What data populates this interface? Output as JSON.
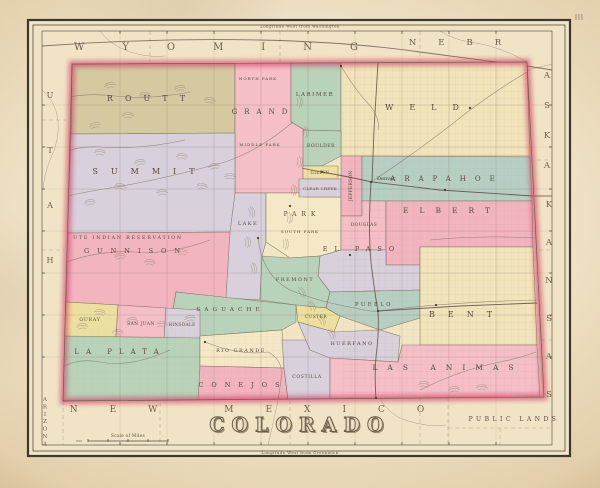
{
  "page": {
    "map_title": "COLORADO",
    "top_caption": "Longitude West from Washington",
    "bottom_caption": "Longitude West from Greenwich",
    "scale_caption": "Scale of Miles"
  },
  "colors": {
    "paper": "#f1e4c6",
    "state_base": "#f2e5c4",
    "frame": "#3e372e",
    "state_border_red": "#cf3560",
    "county_line": "#6e6150",
    "label_ink": "#574a3d",
    "neighbor_ink": "#6d5d4b",
    "water_ink": "#7d7060",
    "rail_ink": "#4f4438",
    "pink": "#f2b4bf",
    "pink2": "#f5bfc7",
    "green": "#b9d2ba",
    "teal": "#b7cfc2",
    "cream": "#f1e3ba",
    "cream2": "#f4e8c6",
    "lavender": "#d8d0da",
    "yellow": "#ecdf9f",
    "olive": "#d5c9a2"
  },
  "frame": {
    "outer": [
      28,
      20,
      542,
      436
    ],
    "outer2": [
      33,
      25,
      532,
      426
    ],
    "inner": [
      42,
      31,
      510,
      414
    ],
    "top_caption_pos": [
      300,
      27.5
    ],
    "bottom_caption_pos": [
      300,
      454
    ]
  },
  "state_outline": "M72,64 L527,62 L544,397 L63,401 Z",
  "graticule": {
    "xs": [
      120,
      167,
      214,
      261,
      308,
      355,
      402,
      449,
      496
    ],
    "ys": [
      105,
      147,
      189,
      231,
      273,
      315,
      357
    ]
  },
  "counties": [
    {
      "name": "ROUTT",
      "color": "olive",
      "points": "72,64 235,63 235,133 71,134",
      "label": {
        "x": 152,
        "y": 101,
        "size": 8,
        "spacing": 12
      }
    },
    {
      "name": "GRAND",
      "color": "pink2",
      "points": "235,63 291,62 291,122 305,130 303,179 299,193 235,193",
      "label": {
        "x": 263,
        "y": 114,
        "size": 7,
        "spacing": 7
      }
    },
    {
      "name": "LARIMER",
      "color": "green",
      "points": "291,62 341,61 341,131 305,130 291,122",
      "label": {
        "x": 315,
        "y": 96,
        "size": 5.5,
        "spacing": 1.5
      }
    },
    {
      "name": "WELD",
      "color": "cream",
      "points": "341,61 527,62 530,156 341,156",
      "label": {
        "x": 430,
        "y": 110,
        "size": 8,
        "spacing": 16
      }
    },
    {
      "name": "SUMMIT",
      "color": "lavender",
      "points": "71,134 235,133 235,232 67,233",
      "label": {
        "x": 150,
        "y": 174,
        "size": 8,
        "spacing": 13
      }
    },
    {
      "name": "GUNNISON",
      "color": "pink",
      "points": "67,233 235,232 228,298 176,292 172,316 160,310 118,305 66,302",
      "label": {
        "x": 136,
        "y": 253,
        "size": 6.5,
        "spacing": 8
      }
    },
    {
      "name": "LAKE",
      "color": "lavender",
      "points": "235,193 266,193 266,242 262,256 260,300 226,298 230,232",
      "label": {
        "x": 248,
        "y": 225,
        "size": 5,
        "spacing": 1.5
      }
    },
    {
      "name": "PARK",
      "color": "cream2",
      "points": "266,193 305,193 305,197 341,197 341,250 320,256 290,258 266,242",
      "label": {
        "x": 302,
        "y": 216,
        "size": 6,
        "spacing": 5
      }
    },
    {
      "name": "BOULDER",
      "color": "green",
      "points": "303,130 341,131 341,156 322,166 303,166",
      "label": {
        "x": 321,
        "y": 147,
        "size": 4.6,
        "spacing": 0.5
      }
    },
    {
      "name": "GILPIN",
      "color": "yellow",
      "points": "303,166 338,166 338,179 303,179",
      "label": {
        "x": 320,
        "y": 174,
        "size": 4.2,
        "spacing": 0.5
      }
    },
    {
      "name": "CLEAR CREEK",
      "color": "lavender",
      "points": "299,179 341,179 341,197 299,197",
      "label": {
        "x": 320,
        "y": 190,
        "size": 4,
        "spacing": 0.3
      }
    },
    {
      "name": "JEFFERSON",
      "color": "pink",
      "points": "341,156 362,156 362,216 341,216",
      "label": {
        "x": 352,
        "y": 186,
        "size": 4.4,
        "spacing": 0.3,
        "rot": -90
      }
    },
    {
      "name": "ARAPAHOE",
      "color": "teal",
      "points": "362,156 530,157 532,201 362,201",
      "label": {
        "x": 447,
        "y": 181,
        "size": 7,
        "spacing": 9
      }
    },
    {
      "name": "DOUGLAS",
      "color": "pink2",
      "points": "341,216 362,216 362,201 386,201 386,250 341,250",
      "label": {
        "x": 364,
        "y": 226,
        "size": 4.4,
        "spacing": 0.4
      }
    },
    {
      "name": "ELBERT",
      "color": "pink",
      "points": "386,201 532,201 533,247 420,247 420,265 386,265",
      "label": {
        "x": 452,
        "y": 213,
        "size": 7.5,
        "spacing": 11
      }
    },
    {
      "name": "EL PASO",
      "color": "lavender",
      "points": "320,256 341,250 386,250 386,265 420,265 420,290 330,292 318,276",
      "label": {
        "x": 362,
        "y": 251,
        "size": 6.5,
        "spacing": 7
      }
    },
    {
      "name": "FREMONT",
      "color": "green",
      "points": "262,256 290,258 320,256 318,276 330,292 326,308 296,305 260,300",
      "label": {
        "x": 295,
        "y": 281,
        "size": 5,
        "spacing": 1.5
      }
    },
    {
      "name": "SAGUACHE",
      "color": "green",
      "points": "176,292 250,300 296,305 296,322 282,330 200,336 172,316",
      "label": {
        "x": 230,
        "y": 311,
        "size": 5.8,
        "spacing": 4
      }
    },
    {
      "name": "CUSTER",
      "color": "yellow",
      "points": "296,305 326,308 340,316 334,332 298,322",
      "label": {
        "x": 316,
        "y": 318,
        "size": 4.4,
        "spacing": 0.5
      }
    },
    {
      "name": "PUEBLO",
      "color": "teal",
      "points": "330,292 420,290 420,318 380,330 340,316 326,308",
      "label": {
        "x": 374,
        "y": 306,
        "size": 5.2,
        "spacing": 2.5
      }
    },
    {
      "name": "BENT",
      "color": "cream",
      "points": "420,247 533,247 537,345 420,345",
      "label": {
        "x": 467,
        "y": 317,
        "size": 8,
        "spacing": 13
      }
    },
    {
      "name": "OURAY",
      "color": "yellow",
      "points": "66,302 118,305 116,338 64,336",
      "label": {
        "x": 90,
        "y": 321,
        "size": 4.6,
        "spacing": 0.8
      }
    },
    {
      "name": "SAN JUAN",
      "color": "pink2",
      "points": "118,305 166,308 164,340 116,338",
      "label": {
        "x": 141,
        "y": 325,
        "size": 4.4,
        "spacing": 0.5
      }
    },
    {
      "name": "HINSDALE",
      "color": "lavender",
      "points": "166,308 200,310 200,338 164,340",
      "label": {
        "x": 182,
        "y": 326,
        "size": 4.2,
        "spacing": 0.4
      }
    },
    {
      "name": "LA PLATA",
      "color": "green",
      "points": "64,336 200,338 200,401 63,401",
      "label": {
        "x": 120,
        "y": 354,
        "size": 7,
        "spacing": 7
      }
    },
    {
      "name": "RIO GRANDE",
      "color": "cream2",
      "points": "200,336 282,330 284,368 200,366",
      "label": {
        "x": 241,
        "y": 352,
        "size": 5,
        "spacing": 1.5
      }
    },
    {
      "name": "CONEJOS",
      "color": "pink",
      "points": "200,366 284,368 288,400 198,401",
      "label": {
        "x": 243,
        "y": 387,
        "size": 6.5,
        "spacing": 8
      }
    },
    {
      "name": "COSTILLA",
      "color": "lavender",
      "points": "282,340 330,340 330,400 288,400 284,368",
      "label": {
        "x": 307,
        "y": 378,
        "size": 4.6,
        "spacing": 0.6
      }
    },
    {
      "name": "HUERFANO",
      "color": "lavender",
      "points": "334,332 380,330 400,336 398,362 330,358 310,350 298,322",
      "label": {
        "x": 352,
        "y": 345,
        "size": 5,
        "spacing": 1.5
      }
    },
    {
      "name": "LAS ANIMAS",
      "color": "pink2",
      "points": "330,358 398,362 402,345 420,345 537,345 540,397 330,400",
      "label": {
        "x": 448,
        "y": 370,
        "size": 7.5,
        "spacing": 10
      }
    }
  ],
  "misc_labels": [
    {
      "id": "ute-reservation-label",
      "text": "UTE INDIAN RESERVATION",
      "x": 128,
      "y": 239,
      "size": 4.8,
      "spacing": 1.8
    },
    {
      "id": "north-park-label",
      "text": "NORTH PARK",
      "x": 258,
      "y": 80,
      "size": 4,
      "spacing": 1
    },
    {
      "id": "middle-park-label",
      "text": "MIDDLE PARK",
      "x": 260,
      "y": 146,
      "size": 4,
      "spacing": 1
    },
    {
      "id": "south-park-label",
      "text": "SOUTH PARK",
      "x": 300,
      "y": 233,
      "size": 4,
      "spacing": 1
    },
    {
      "id": "public-lands-label",
      "text": "PUBLIC LANDS",
      "x": 514,
      "y": 421,
      "size": 6,
      "spacing": 3.5
    }
  ],
  "neighbors": [
    {
      "id": "wyoming-label",
      "text": "WYOMING",
      "x": 235,
      "y": 50,
      "size": 10,
      "spacing": 38
    },
    {
      "id": "nebraska-label-h",
      "text": "NEBR",
      "x": 466,
      "y": 45,
      "size": 8.5,
      "spacing": 22
    },
    {
      "id": "nebraska-label-v",
      "text": "ASKA",
      "x": 547,
      "y": 78,
      "size": 8.5,
      "vertical": true,
      "vspacing": 30
    },
    {
      "id": "kansas-label",
      "text": "KANSAS",
      "x": 549,
      "y": 207,
      "size": 8.5,
      "vertical": true,
      "vspacing": 38
    },
    {
      "id": "new-mexico-label",
      "text": "NEW MEXICO",
      "x": 263,
      "y": 412,
      "size": 9,
      "spacing": 32
    },
    {
      "id": "utah-label",
      "text": "UTAH",
      "x": 50,
      "y": 98,
      "size": 8,
      "vertical": true,
      "vspacing": 55
    },
    {
      "id": "arizona-label",
      "text": "ARIZONA",
      "x": 45,
      "y": 401,
      "size": 5.5,
      "vertical": true,
      "vspacing": 7.4
    }
  ],
  "towns": [
    {
      "name": "Denver",
      "x": 371,
      "y": 182,
      "labeled": true
    },
    {
      "x": 378,
      "y": 311
    },
    {
      "x": 322,
      "y": 172
    },
    {
      "x": 341,
      "y": 66
    },
    {
      "x": 350,
      "y": 255
    },
    {
      "x": 290,
      "y": 206
    },
    {
      "x": 258,
      "y": 238
    },
    {
      "x": 205,
      "y": 342
    },
    {
      "x": 445,
      "y": 190
    },
    {
      "x": 470,
      "y": 108
    },
    {
      "x": 436,
      "y": 305
    },
    {
      "x": 376,
      "y": 398
    }
  ],
  "rivers": [
    "M371,182 Q420,150 470,110 Q500,88 527,72",
    "M341,66 Q355,90 372,108 Q380,120 378,130",
    "M258,238 Q262,275 290,290 Q320,302 355,308 Q370,312 378,311 Q450,302 537,300",
    "M293,122 Q260,150 225,162 Q160,180 110,188 Q85,192 67,196",
    "M190,92 Q150,100 115,96 Q90,93 70,97",
    "M185,140 Q140,150 100,147 Q82,146 68,151",
    "M210,240 Q170,255 135,252 Q100,250 67,262",
    "M205,342 Q240,356 268,352 Q280,358 282,372 Q280,388 278,400",
    "M170,350 Q130,368 100,362 Q80,358 64,366",
    "M420,390 Q460,370 500,362 Q520,358 536,352",
    "M430,240 Q480,235 535,238"
  ],
  "railroads": [
    "M372,182 L374,130 L378,62",
    "M372,182 L440,190 L533,196",
    "M371,182 Q368,230 371,262 Q375,295 378,311",
    "M378,311 L460,306 L537,303",
    "M378,311 Q379,330 377,348 Q374,370 376,399",
    "M372,182 Q345,176 322,172 Q310,170 302,168"
  ],
  "margin_paths": [
    {
      "kind": "boundary",
      "d": "M150,31 V62"
    },
    {
      "kind": "boundary",
      "d": "M280,31 V62"
    },
    {
      "kind": "boundary",
      "d": "M420,31 V60"
    },
    {
      "kind": "boundary",
      "d": "M530,160 H552"
    },
    {
      "kind": "boundary",
      "d": "M532,250 H552"
    },
    {
      "kind": "boundary",
      "d": "M534,340 H552"
    },
    {
      "kind": "boundary",
      "d": "M290,400 V445"
    },
    {
      "kind": "boundary",
      "d": "M420,398 V445"
    },
    {
      "kind": "boundary",
      "d": "M160,403 V445"
    },
    {
      "kind": "boundary",
      "d": "M63,401 V445"
    },
    {
      "kind": "boundary",
      "d": "M42,120 H66"
    },
    {
      "kind": "boundary",
      "d": "M42,250 H64"
    },
    {
      "kind": "boundary",
      "d": "M448,398 V445"
    },
    {
      "kind": "boundary",
      "d": "M448,428 H552"
    },
    {
      "kind": "boundary",
      "d": "M500,428 V445"
    },
    {
      "kind": "river",
      "d": "M527,70 Q545,66 552,64"
    },
    {
      "kind": "river",
      "d": "M42,90 Q55,100 58,120 Q60,140 50,160 Q44,175 43,190"
    },
    {
      "kind": "river",
      "d": "M100,31 Q110,45 130,52 Q150,58 165,56"
    },
    {
      "kind": "river",
      "d": "M440,31 Q455,40 470,42 Q500,46 527,62"
    },
    {
      "kind": "river",
      "d": "M278,400 Q274,420 268,445"
    },
    {
      "kind": "river",
      "d": "M380,399 Q390,415 405,420 Q430,428 446,425"
    },
    {
      "kind": "rail",
      "d": "M42,46 Q150,38 260,40 Q350,42 420,52 Q480,60 527,66 Q540,68 552,70"
    },
    {
      "kind": "rail",
      "d": "M533,196 H552"
    }
  ],
  "terrain": [
    [
      110,
      85,
      -10
    ],
    [
      145,
      95,
      5
    ],
    [
      180,
      88,
      -5
    ],
    [
      210,
      100,
      8
    ],
    [
      128,
      115,
      0
    ],
    [
      95,
      125,
      -12
    ],
    [
      100,
      152,
      5
    ],
    [
      140,
      162,
      -6
    ],
    [
      182,
      156,
      4
    ],
    [
      214,
      166,
      -8
    ],
    [
      120,
      186,
      6
    ],
    [
      162,
      192,
      -4
    ],
    [
      202,
      186,
      5
    ],
    [
      90,
      202,
      -6
    ],
    [
      230,
      176,
      0
    ],
    [
      300,
      102,
      90
    ],
    [
      306,
      132,
      85
    ],
    [
      300,
      162,
      95
    ],
    [
      294,
      190,
      88
    ],
    [
      290,
      218,
      92
    ],
    [
      286,
      244,
      90
    ],
    [
      252,
      212,
      80
    ],
    [
      248,
      242,
      85
    ],
    [
      254,
      268,
      78
    ],
    [
      302,
      292,
      60
    ],
    [
      312,
      306,
      55
    ],
    [
      322,
      320,
      58
    ],
    [
      332,
      334,
      60
    ],
    [
      100,
      312,
      10
    ],
    [
      132,
      320,
      -5
    ],
    [
      162,
      324,
      6
    ],
    [
      190,
      318,
      -8
    ],
    [
      118,
      332,
      4
    ],
    [
      82,
      326,
      -6
    ],
    [
      182,
      252,
      0
    ],
    [
      150,
      262,
      8
    ],
    [
      120,
      256,
      -6
    ],
    [
      424,
      384,
      5
    ],
    [
      454,
      389,
      -4
    ],
    [
      482,
      387,
      3
    ],
    [
      95,
      42,
      0
    ],
    [
      135,
      46,
      6
    ]
  ],
  "scale_bar": {
    "x1": 88,
    "x2": 168,
    "y": 441,
    "caption_pos": [
      128,
      437
    ]
  }
}
